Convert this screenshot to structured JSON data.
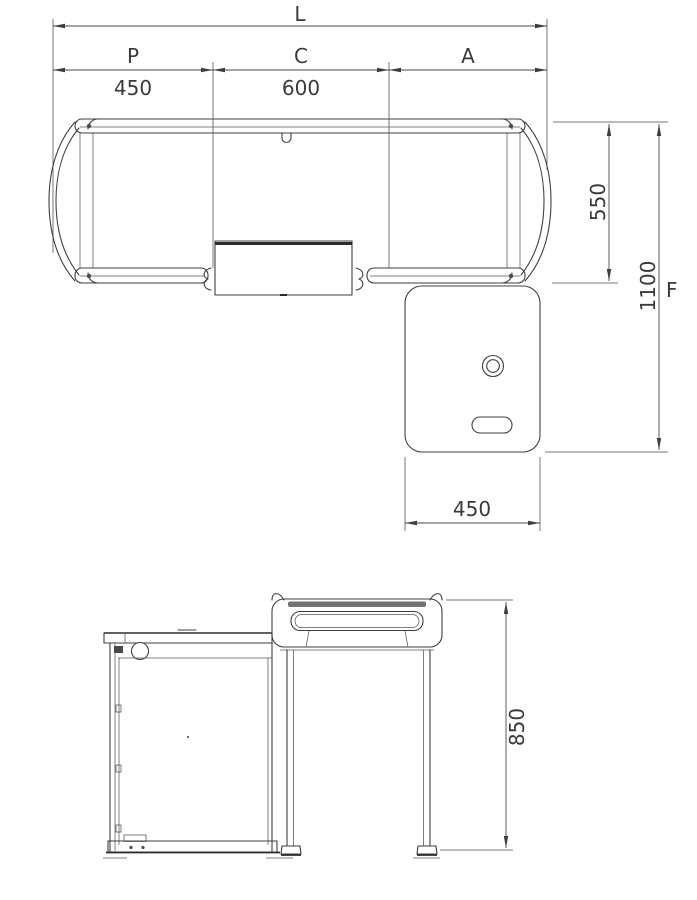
{
  "drawing": {
    "plan": {
      "overall_length_label": "L",
      "left_segment_label": "P",
      "left_segment_value": "450",
      "center_segment_label": "C",
      "center_segment_value": "600",
      "right_segment_label": "A",
      "desk_depth_value": "550",
      "overall_depth_value": "1100",
      "overall_depth_label": "F",
      "return_width_value": "450"
    },
    "elevation": {
      "height_value": "850"
    },
    "colors": {
      "line": "#3f3f3f",
      "dimension": "#4a4a4a",
      "background": "#ffffff"
    }
  }
}
